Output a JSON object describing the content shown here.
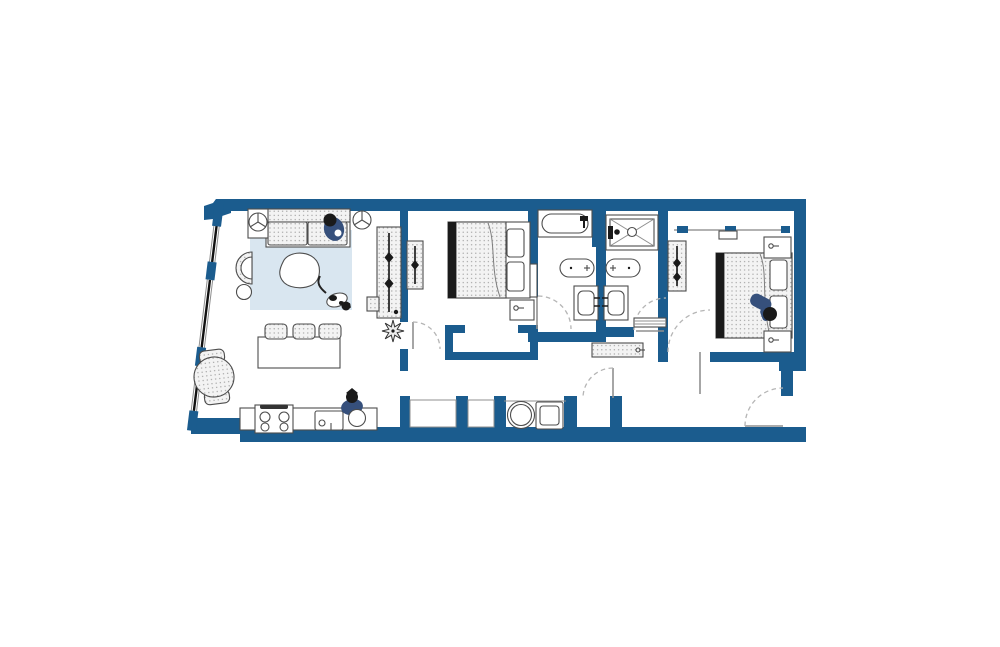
{
  "scene": {
    "type": "apartment-floor-plan",
    "width": 1000,
    "height": 647,
    "text_labels": []
  },
  "palette": {
    "background": "#ffffff",
    "wall": "#1b5c8e",
    "outline": "#4d4d4d",
    "hatch_bg": "#f3f3f3",
    "hatch_dot": "#9a9a9a",
    "rug": "#d9e6f0",
    "figure": "#36507c",
    "dark": "#1a1a1a",
    "door_arc": "#b5b5b5",
    "thin_line": "#8f8f8f",
    "glazing": "#111111"
  },
  "elements": [
    {
      "name": "exterior-walls",
      "kind": "structure"
    },
    {
      "name": "window-wall",
      "kind": "structure",
      "windows": 3
    },
    {
      "name": "interior-walls",
      "kind": "structure"
    },
    {
      "name": "door-swings",
      "kind": "structure",
      "count": 6
    },
    {
      "name": "area-rug",
      "kind": "furniture"
    },
    {
      "name": "sofa",
      "kind": "furniture"
    },
    {
      "name": "person-on-sofa",
      "kind": "figure"
    },
    {
      "name": "floor-lamp",
      "kind": "fixture",
      "count": 2
    },
    {
      "name": "coffee-table",
      "kind": "furniture"
    },
    {
      "name": "cat",
      "kind": "figure"
    },
    {
      "name": "armchair",
      "kind": "furniture"
    },
    {
      "name": "side-table",
      "kind": "furniture"
    },
    {
      "name": "clothes-rack-large",
      "kind": "furniture"
    },
    {
      "name": "clothes-rack-small",
      "kind": "furniture"
    },
    {
      "name": "potted-plant",
      "kind": "decor"
    },
    {
      "name": "kitchen-island",
      "kind": "furniture"
    },
    {
      "name": "bar-stool",
      "kind": "furniture",
      "count": 3
    },
    {
      "name": "round-dining-table",
      "kind": "furniture"
    },
    {
      "name": "dining-chair",
      "kind": "furniture",
      "count": 2
    },
    {
      "name": "kitchen-counter",
      "kind": "fixture"
    },
    {
      "name": "stove",
      "kind": "appliance"
    },
    {
      "name": "kitchen-sink",
      "kind": "fixture"
    },
    {
      "name": "person-cooking",
      "kind": "figure"
    },
    {
      "name": "bed-1",
      "kind": "furniture"
    },
    {
      "name": "nightstand",
      "kind": "furniture",
      "count": 3
    },
    {
      "name": "closet-bedroom-1",
      "kind": "structure"
    },
    {
      "name": "bathtub",
      "kind": "fixture"
    },
    {
      "name": "toilet",
      "kind": "fixture",
      "count": 2
    },
    {
      "name": "vanity-sink",
      "kind": "fixture",
      "count": 2
    },
    {
      "name": "shower",
      "kind": "fixture"
    },
    {
      "name": "towel-shelf",
      "kind": "fixture"
    },
    {
      "name": "hall-bench",
      "kind": "furniture"
    },
    {
      "name": "wardrobe-bedroom-2",
      "kind": "furniture"
    },
    {
      "name": "closet-rail-bedroom-2",
      "kind": "structure"
    },
    {
      "name": "bed-2",
      "kind": "furniture"
    },
    {
      "name": "person-on-bed",
      "kind": "figure"
    },
    {
      "name": "washer",
      "kind": "appliance"
    },
    {
      "name": "dryer",
      "kind": "appliance"
    },
    {
      "name": "entry-door",
      "kind": "structure"
    }
  ]
}
